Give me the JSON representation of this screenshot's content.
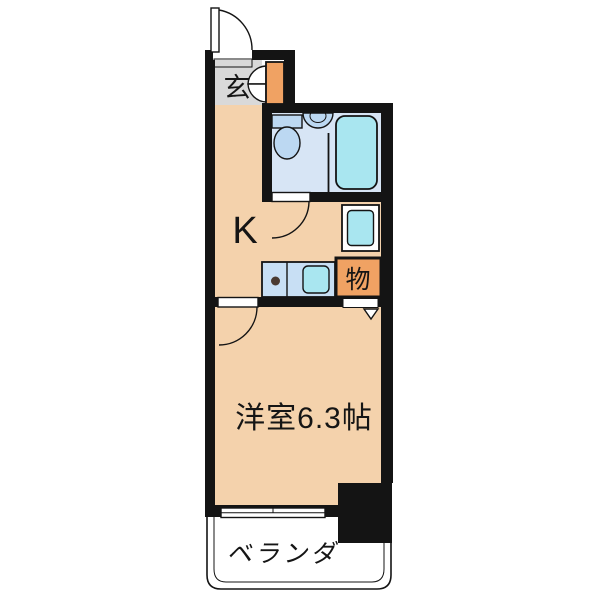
{
  "labels": {
    "entrance": "玄",
    "kitchen": "K",
    "storage": "物",
    "western_room": "洋室6.3帖",
    "balcony": "ベランダ"
  },
  "colors": {
    "wall": "#141414",
    "room_fill": "#F4D2AC",
    "entrance_fill": "#D9D9D9",
    "accent_orange": "#F0A263",
    "bath_floor": "#D7E5F5",
    "fixture_blue": "#BCD8F2",
    "cyan": "#A9E6F0",
    "counter_blue": "#C8DFF4",
    "balcony_fill": "#DCD8CD",
    "burner_dot": "#4A3A30",
    "background": "#FFFFFF",
    "door_fill": "#FFFFFF"
  }
}
